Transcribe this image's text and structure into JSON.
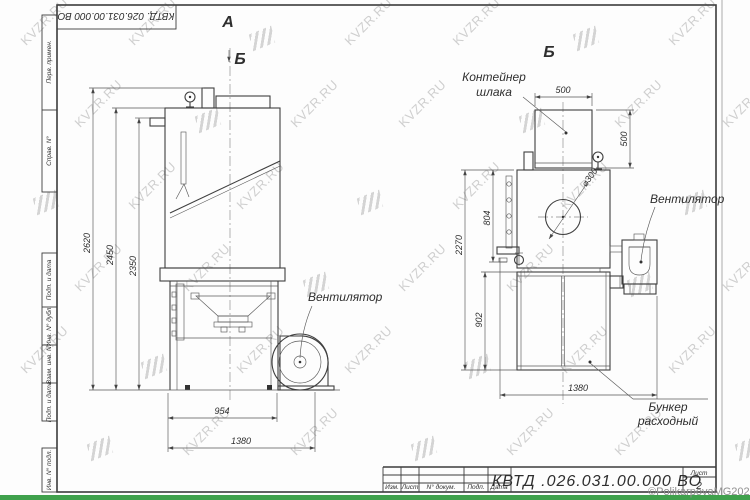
{
  "watermark": {
    "text": "KVZR.RU",
    "copyright": "©PolikarpovaMG2021"
  },
  "sheet": {
    "frame_fields": [
      "Перв. примен.",
      "Справ. N°",
      "Подп. и дата",
      "Инв. N° дубл.",
      "Взам. инв. N°",
      "Подп. и дата",
      "Инв. N° подл."
    ],
    "top_designation": "КВТД. 026.031.00.000  ВО",
    "title_block": {
      "doc_number": "КВТД .026.031.00.000  ВО",
      "columns": [
        "Изм.",
        "Лист",
        "N° докум.",
        "Подп.",
        "Дата"
      ],
      "sheet_label": "Лист",
      "sheet_number": "2"
    }
  },
  "front_view": {
    "label": "А",
    "section_mark": "Б",
    "fan_label": "Вентилятор",
    "dims": {
      "total_height": "2620",
      "body_height": "2450",
      "inner_height": "2350",
      "stand_width": "954",
      "total_width": "1380"
    }
  },
  "side_view": {
    "label": "Б",
    "container_label_1": "Контейнер",
    "container_label_2": "шлака",
    "fan_label": "Вентилятор",
    "bunker_label_1": "Бункер",
    "bunker_label_2": "расходный",
    "dims": {
      "container_width": "500",
      "container_height": "500",
      "diameter": "⌀300",
      "door_height": "804",
      "total_height": "2270",
      "bunker_height": "902",
      "total_width": "1380"
    }
  }
}
